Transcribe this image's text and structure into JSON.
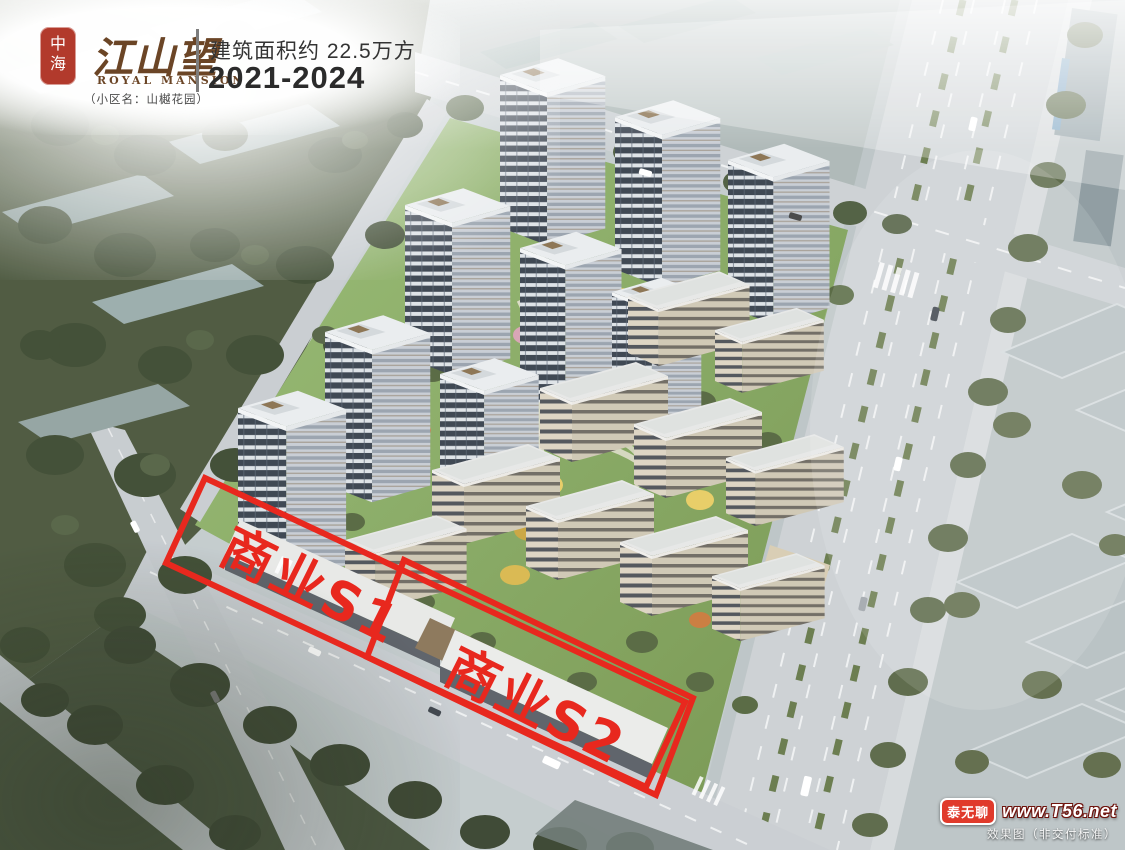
{
  "header": {
    "seal": "中海",
    "brand": "江山望",
    "brand_en": "ROYAL MANSION",
    "community_note": "（小区名：山樾花园）",
    "area_text": "建筑面积约 22.5万方",
    "years_text": "2021-2024"
  },
  "annotations": {
    "s1_label": "商业S1",
    "s2_label": "商业S2",
    "accent_color": "#e8281e"
  },
  "watermark": {
    "badge": "泰无聊",
    "site": "www.T56.net",
    "disclaimer": "效果图（非交付标准）"
  },
  "colors": {
    "annotation_red": "#e8281e",
    "seal_red": "#b23a2c",
    "brand_brown": "#6b4526",
    "lawn_green": "#8db06a",
    "road_gray": "#ccd1d4"
  }
}
